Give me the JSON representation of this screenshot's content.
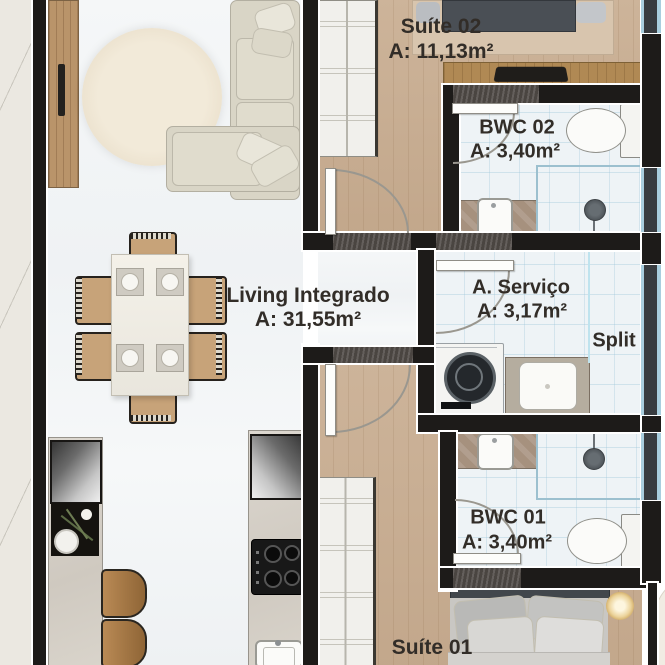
{
  "title": "Apartment floor plan",
  "rooms": {
    "suite02": {
      "name": "Suíte 02",
      "area": "A: 11,13m²"
    },
    "bwc02": {
      "name": "BWC 02",
      "area": "A: 3,40m²"
    },
    "living": {
      "name": "Living Integrado",
      "area": "A: 31,55m²"
    },
    "servico": {
      "name": "A. Serviço",
      "area": "A: 3,17m²"
    },
    "bwc01": {
      "name": "BWC 01",
      "area": "A: 3,40m²"
    },
    "suite01": {
      "name": "Suíte 01"
    }
  },
  "annotations": {
    "split": "Split"
  },
  "colors": {
    "wall": "#1d1b19",
    "wood_floor": "#c9ae92",
    "tile_floor": "#eef3f6",
    "living_floor": "#f3f5f6",
    "window_blue": "#a9cede",
    "label_text": "#322d28",
    "counter_marble": "#d5d0c7",
    "sofa_beige": "#d9d5c6"
  }
}
